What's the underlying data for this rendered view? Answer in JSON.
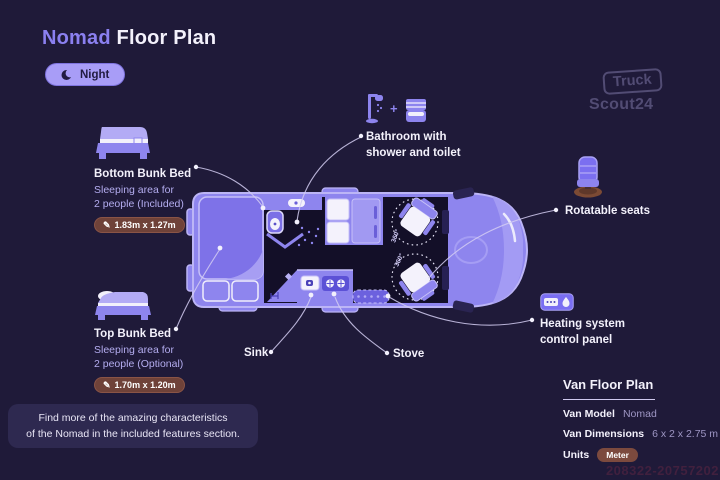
{
  "header": {
    "title_accent": "Nomad",
    "title_rest": " Floor Plan",
    "mode_toggle_label": "Night"
  },
  "logo": {
    "line1": "Truck",
    "line2": "Scout24"
  },
  "icons": {
    "pencil": "✎"
  },
  "callouts": {
    "bottom_bunk": {
      "title": "Bottom Bunk Bed",
      "desc1": "Sleeping area for",
      "desc2": "2 people (Included)",
      "dimensions": "1.83m x 1.27m"
    },
    "top_bunk": {
      "title": "Top Bunk Bed",
      "desc1": "Sleeping area for",
      "desc2": "2 people (Optional)",
      "dimensions": "1.70m x 1.20m"
    },
    "bathroom": {
      "line1": "Bathroom with",
      "line2": "shower and toilet",
      "plus_sign": "+"
    },
    "rotatable_seats": {
      "label": "Rotatable seats"
    },
    "heating_panel": {
      "line1": "Heating system",
      "line2": "control panel"
    },
    "sink": {
      "label": "Sink"
    },
    "stove": {
      "label": "Stove"
    }
  },
  "van": {
    "rotation_label_front": "360°",
    "rotation_label_rear": "360°"
  },
  "footer_note": {
    "line1": "Find more of the amazing characteristics",
    "line2": "of the Nomad in the included features section."
  },
  "spec_panel": {
    "title": "Van Floor Plan",
    "model_label": "Van Model",
    "model_value": "Nomad",
    "dimensions_label": "Van Dimensions",
    "dimensions_value": "6 x 2 x 2.75 m",
    "units_label": "Units",
    "units_value": "Meter"
  },
  "watermark": "208322-20757202",
  "colors": {
    "background": "#1f1a39",
    "accent_purple": "#8b80f0",
    "toggle_pill": "#a89df7",
    "van_body": "#8e85ee",
    "interior_dark": "#130f28",
    "dimension_badge": "#6f4239",
    "seat_base_brown": "#7c4a34",
    "note_panel_bg": "#2e2950",
    "text_primary": "#f3f1fb",
    "text_secondary": "#b4adf0",
    "connector_line": "#d3cdf2"
  }
}
